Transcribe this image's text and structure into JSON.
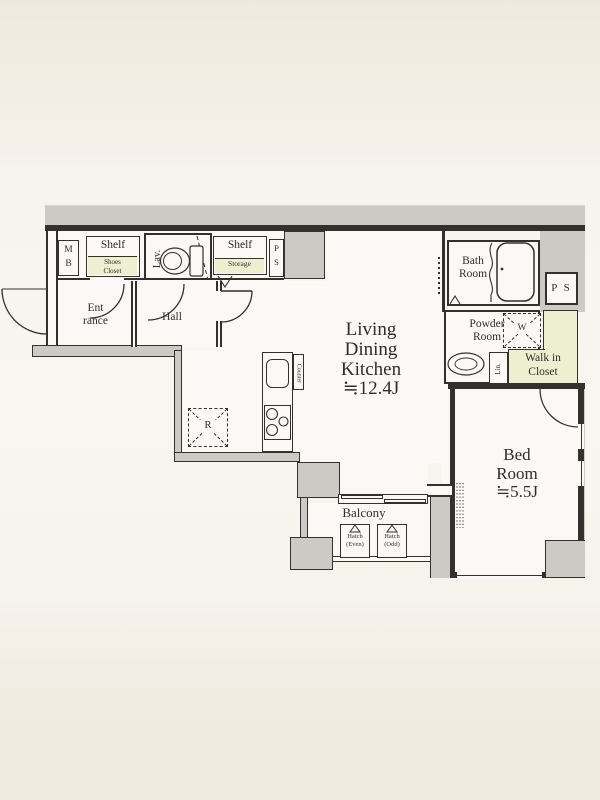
{
  "rooms": {
    "ldk": {
      "l1": "Living",
      "l2": "Dining",
      "l3": "Kitchen",
      "size": "≒12.4J"
    },
    "bedroom": {
      "l1": "Bed",
      "l2": "Room",
      "size": "≒5.5J"
    },
    "bath": {
      "l1": "Bath",
      "l2": "Room"
    },
    "powder": {
      "l1": "Powder",
      "l2": "Room"
    },
    "wic": {
      "l1": "Walk in",
      "l2": "Closet"
    },
    "entrance": {
      "l1": "Ent",
      "l2": "rance"
    },
    "hall": {
      "label": "Hall"
    },
    "lav": {
      "label": "Lav."
    },
    "balcony": {
      "label": "Balcony"
    }
  },
  "storage": {
    "shelf_entrance": {
      "label": "Shelf",
      "s1": "Shoes",
      "s2": "Closet"
    },
    "shelf_storage": {
      "label": "Shelf",
      "s1": "Storage"
    },
    "meter_box": {
      "l1": "M",
      "l2": "B"
    },
    "pipe_space_small": {
      "l1": "P",
      "l2": "S"
    },
    "pipe_space_large": {
      "label": "P S"
    },
    "linen": {
      "label": "Lin."
    },
    "counter": {
      "label": "Counter"
    }
  },
  "fixtures": {
    "refrigerator_space": {
      "label": "R"
    },
    "washer_space": {
      "label": "W"
    },
    "hatch_even": {
      "l1": "Hatch",
      "l2": "(Even)"
    },
    "hatch_odd": {
      "l1": "Hatch",
      "l2": "(Odd)"
    }
  },
  "colors": {
    "wall": "#32312e",
    "exterior_gray": "#cbcac4",
    "floor_white": "#fbf9f5",
    "highlight_yellow": "#edefd0",
    "paper_background": "#f4f0e8"
  }
}
